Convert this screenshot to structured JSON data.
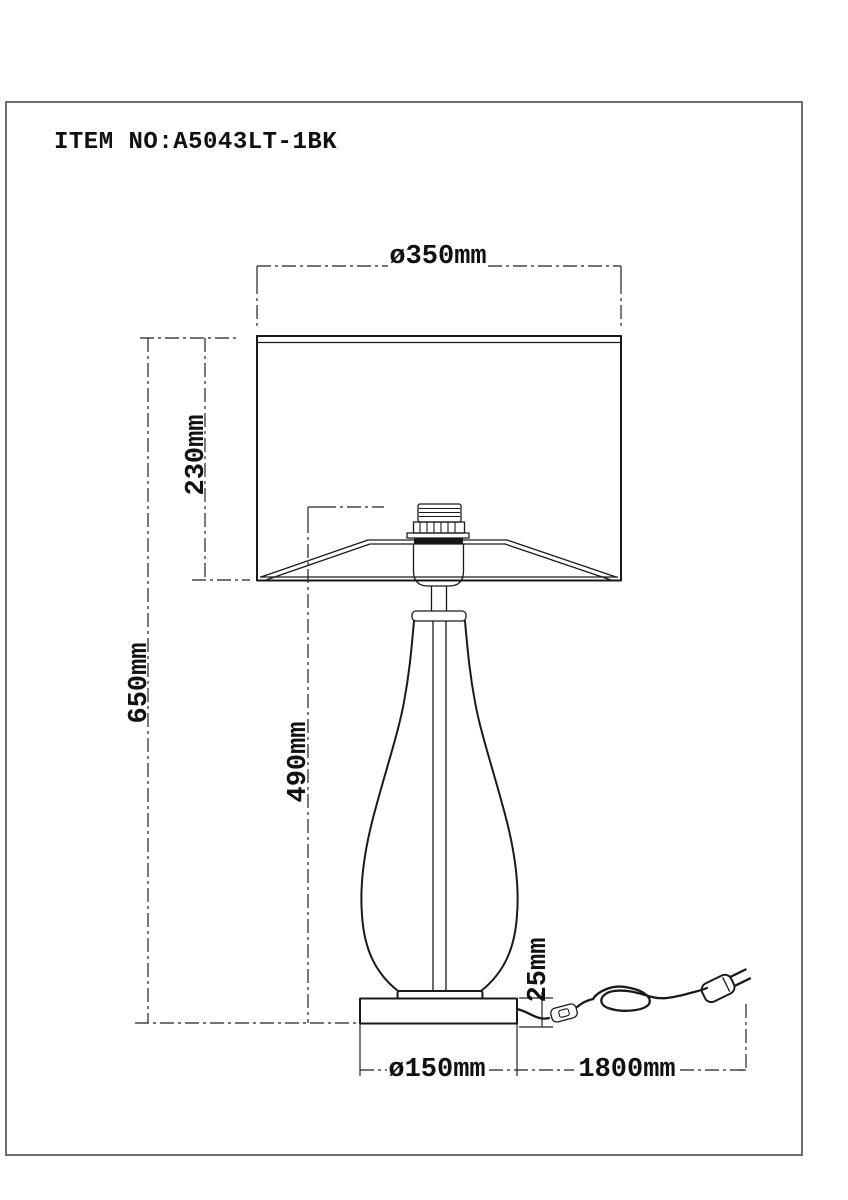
{
  "title": "ITEM NO:A5043LT-1BK",
  "drawing": {
    "dim_shade_diameter": "ø350mm",
    "dim_shade_height": "230mm",
    "dim_total_height": "650mm",
    "dim_body_height": "490mm",
    "dim_base_height": "25mm",
    "dim_base_diameter": "ø150mm",
    "dim_cord_length": "1800mm"
  }
}
